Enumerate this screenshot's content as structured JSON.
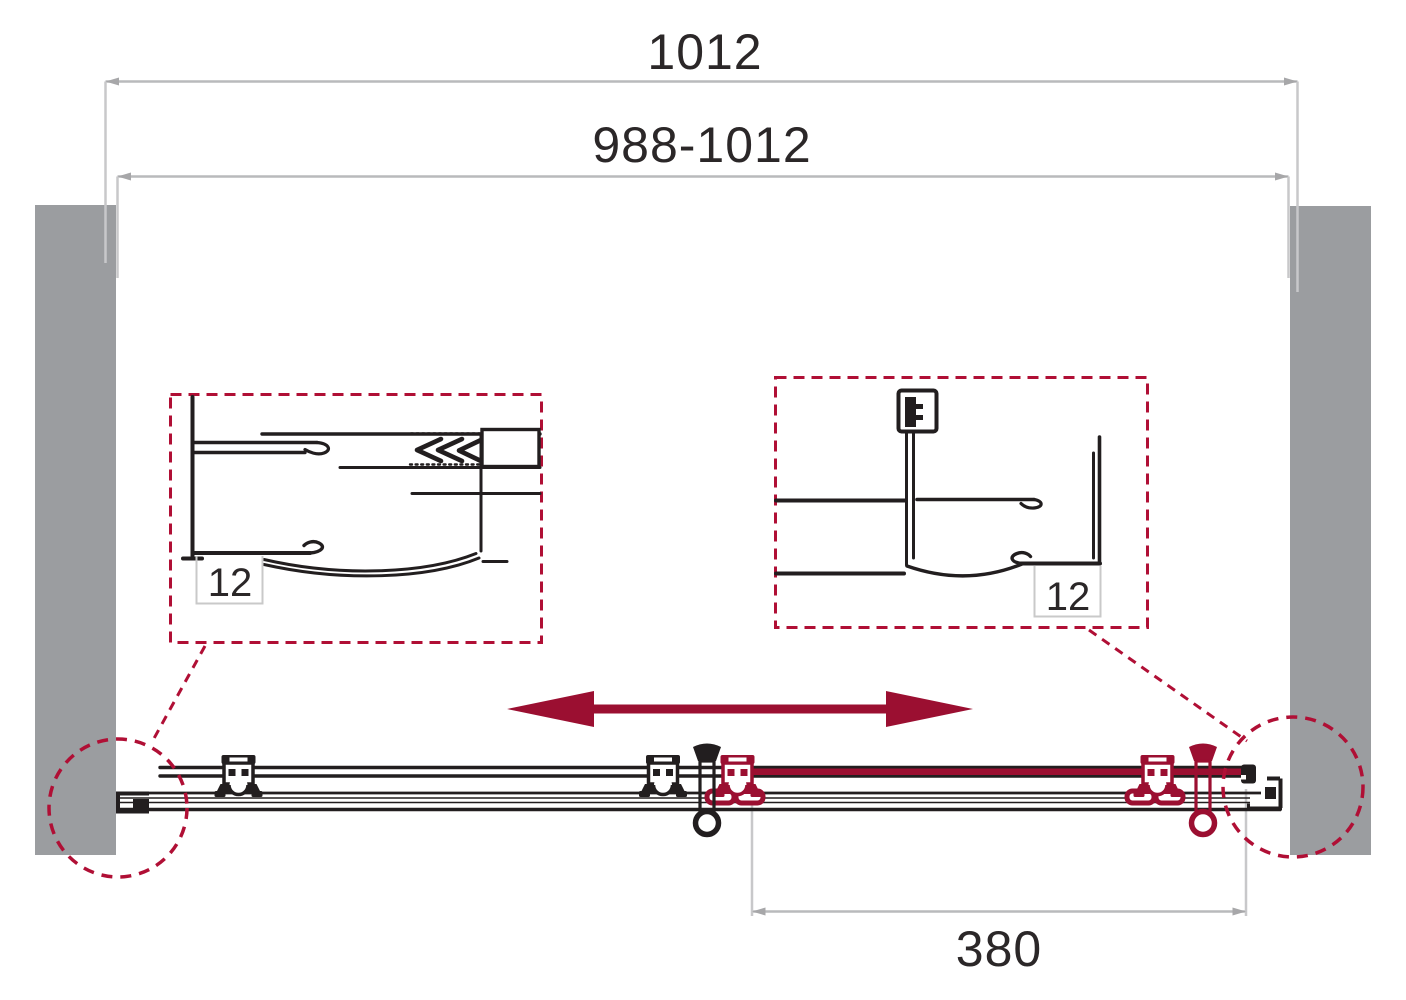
{
  "labels": {
    "overall_width": "1012",
    "adjustment_range": "988-1012",
    "door_travel": "380",
    "glass_thickness_left": "12",
    "glass_thickness_right": "12"
  },
  "colors": {
    "ink": "#221E1F",
    "accent": "#9B0F31",
    "accent_dash": "#B00F35",
    "wall": "#9B9DA0",
    "dim_line": "#B9BABC",
    "dim_ext": "#C8C8CA",
    "dim_arrow": "#A7A7A9",
    "dim_text": "#2B2728",
    "label_box_border": "#C9C9C9"
  },
  "icons": {
    "slide_direction": "double-headed-arrow",
    "detail_markers": "dashed-zoom-circle"
  }
}
